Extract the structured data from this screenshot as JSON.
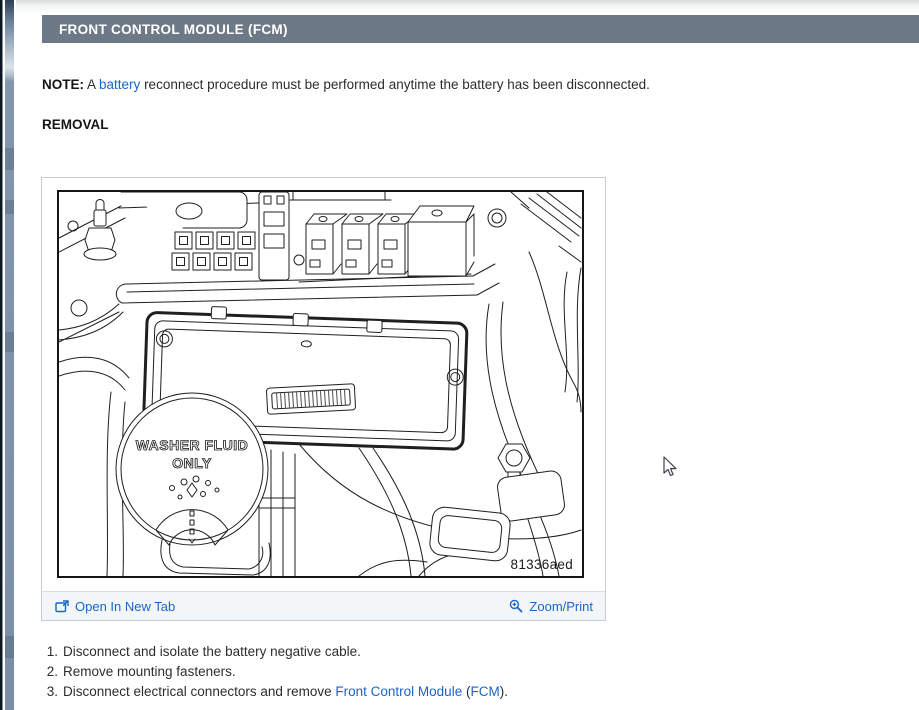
{
  "header": {
    "title": "FRONT CONTROL MODULE (FCM)"
  },
  "note": {
    "label": "NOTE:",
    "before_link": " A ",
    "link": "battery",
    "after_link": " reconnect procedure must be performed anytime the battery has been disconnected."
  },
  "removal_heading": "REMOVAL",
  "figure": {
    "drawing_code": "81336aed",
    "washer_cap": {
      "line1": "WASHER FLUID",
      "line2": "ONLY"
    },
    "footer": {
      "open_in_new_tab": "Open In New Tab",
      "zoom_print": "Zoom/Print"
    }
  },
  "steps": [
    {
      "num": "1.",
      "text": "Disconnect and isolate the battery negative cable."
    },
    {
      "num": "2.",
      "text": "Remove mounting fasteners."
    },
    {
      "num": "3.",
      "text_before": "Disconnect electrical connectors and remove ",
      "link1": "Front Control Module",
      "text_mid": " (",
      "link2": "FCM",
      "text_after": ")."
    }
  ],
  "colors": {
    "link": "#1b65ca",
    "header_bg": "#6d7987",
    "header_text": "#ffffff"
  }
}
